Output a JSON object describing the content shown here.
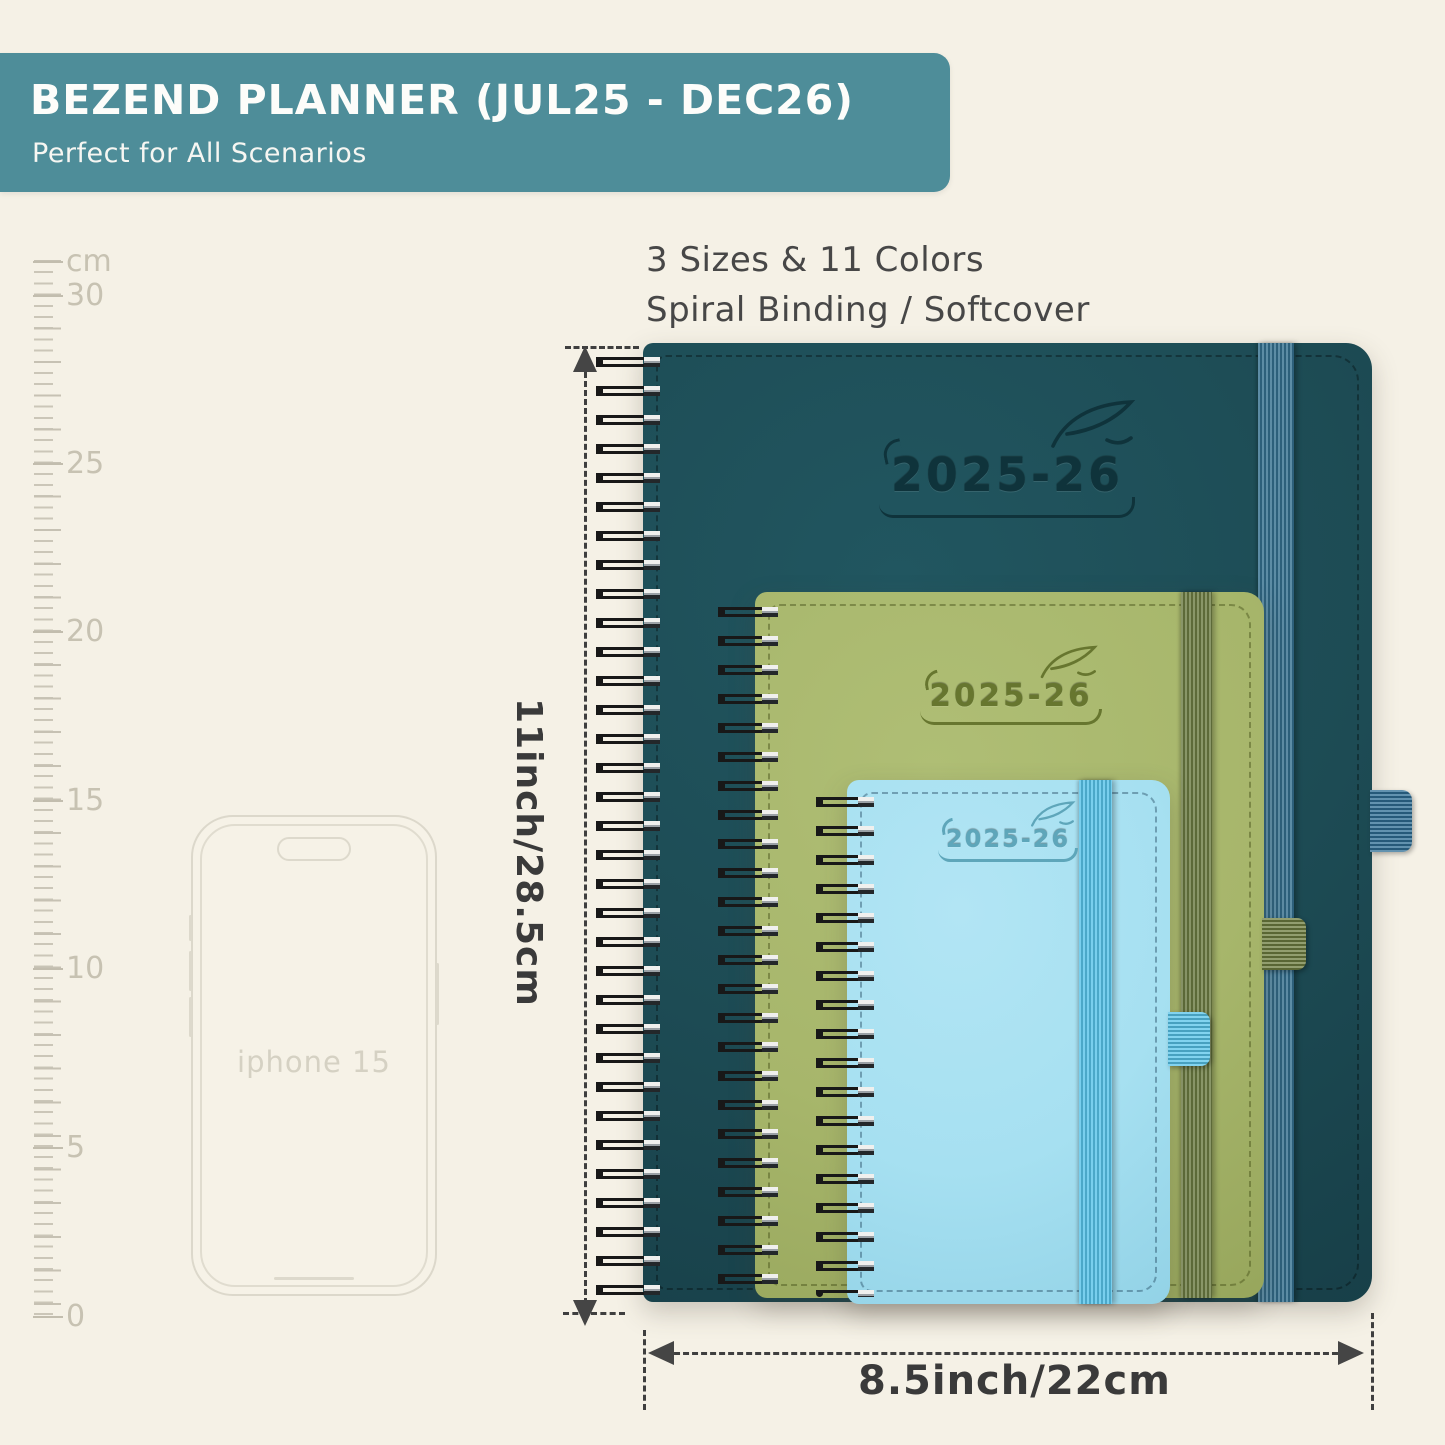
{
  "banner": {
    "title": "BEZEND PLANNER (JUL25 - DEC26)",
    "subtitle": "Perfect for All Scenarios",
    "bg_color": "#4e8d99"
  },
  "headline": {
    "line1": "3 Sizes & 11 Colors",
    "line2": "Spiral Binding / Softcover"
  },
  "ruler": {
    "unit": "cm",
    "labels": [
      "30",
      "25",
      "20",
      "15",
      "10",
      "5",
      "0"
    ]
  },
  "phone": {
    "label": "iphone 15"
  },
  "planners": {
    "large": {
      "year": "2025-26",
      "cover_color": "#1d4b54",
      "band_color": "#34708f"
    },
    "medium": {
      "year": "2025-26",
      "cover_color": "#a7b66b",
      "band_color": "#6c7c42"
    },
    "small": {
      "year": "2025-26",
      "cover_color": "#a6e0f1",
      "band_color": "#57c3ea"
    }
  },
  "dimensions": {
    "height_label": "11inch/28.5cm",
    "width_label": "8.5inch/22cm",
    "line_color": "#3f3f3f"
  },
  "icons": {
    "feather": "feather-quill"
  }
}
